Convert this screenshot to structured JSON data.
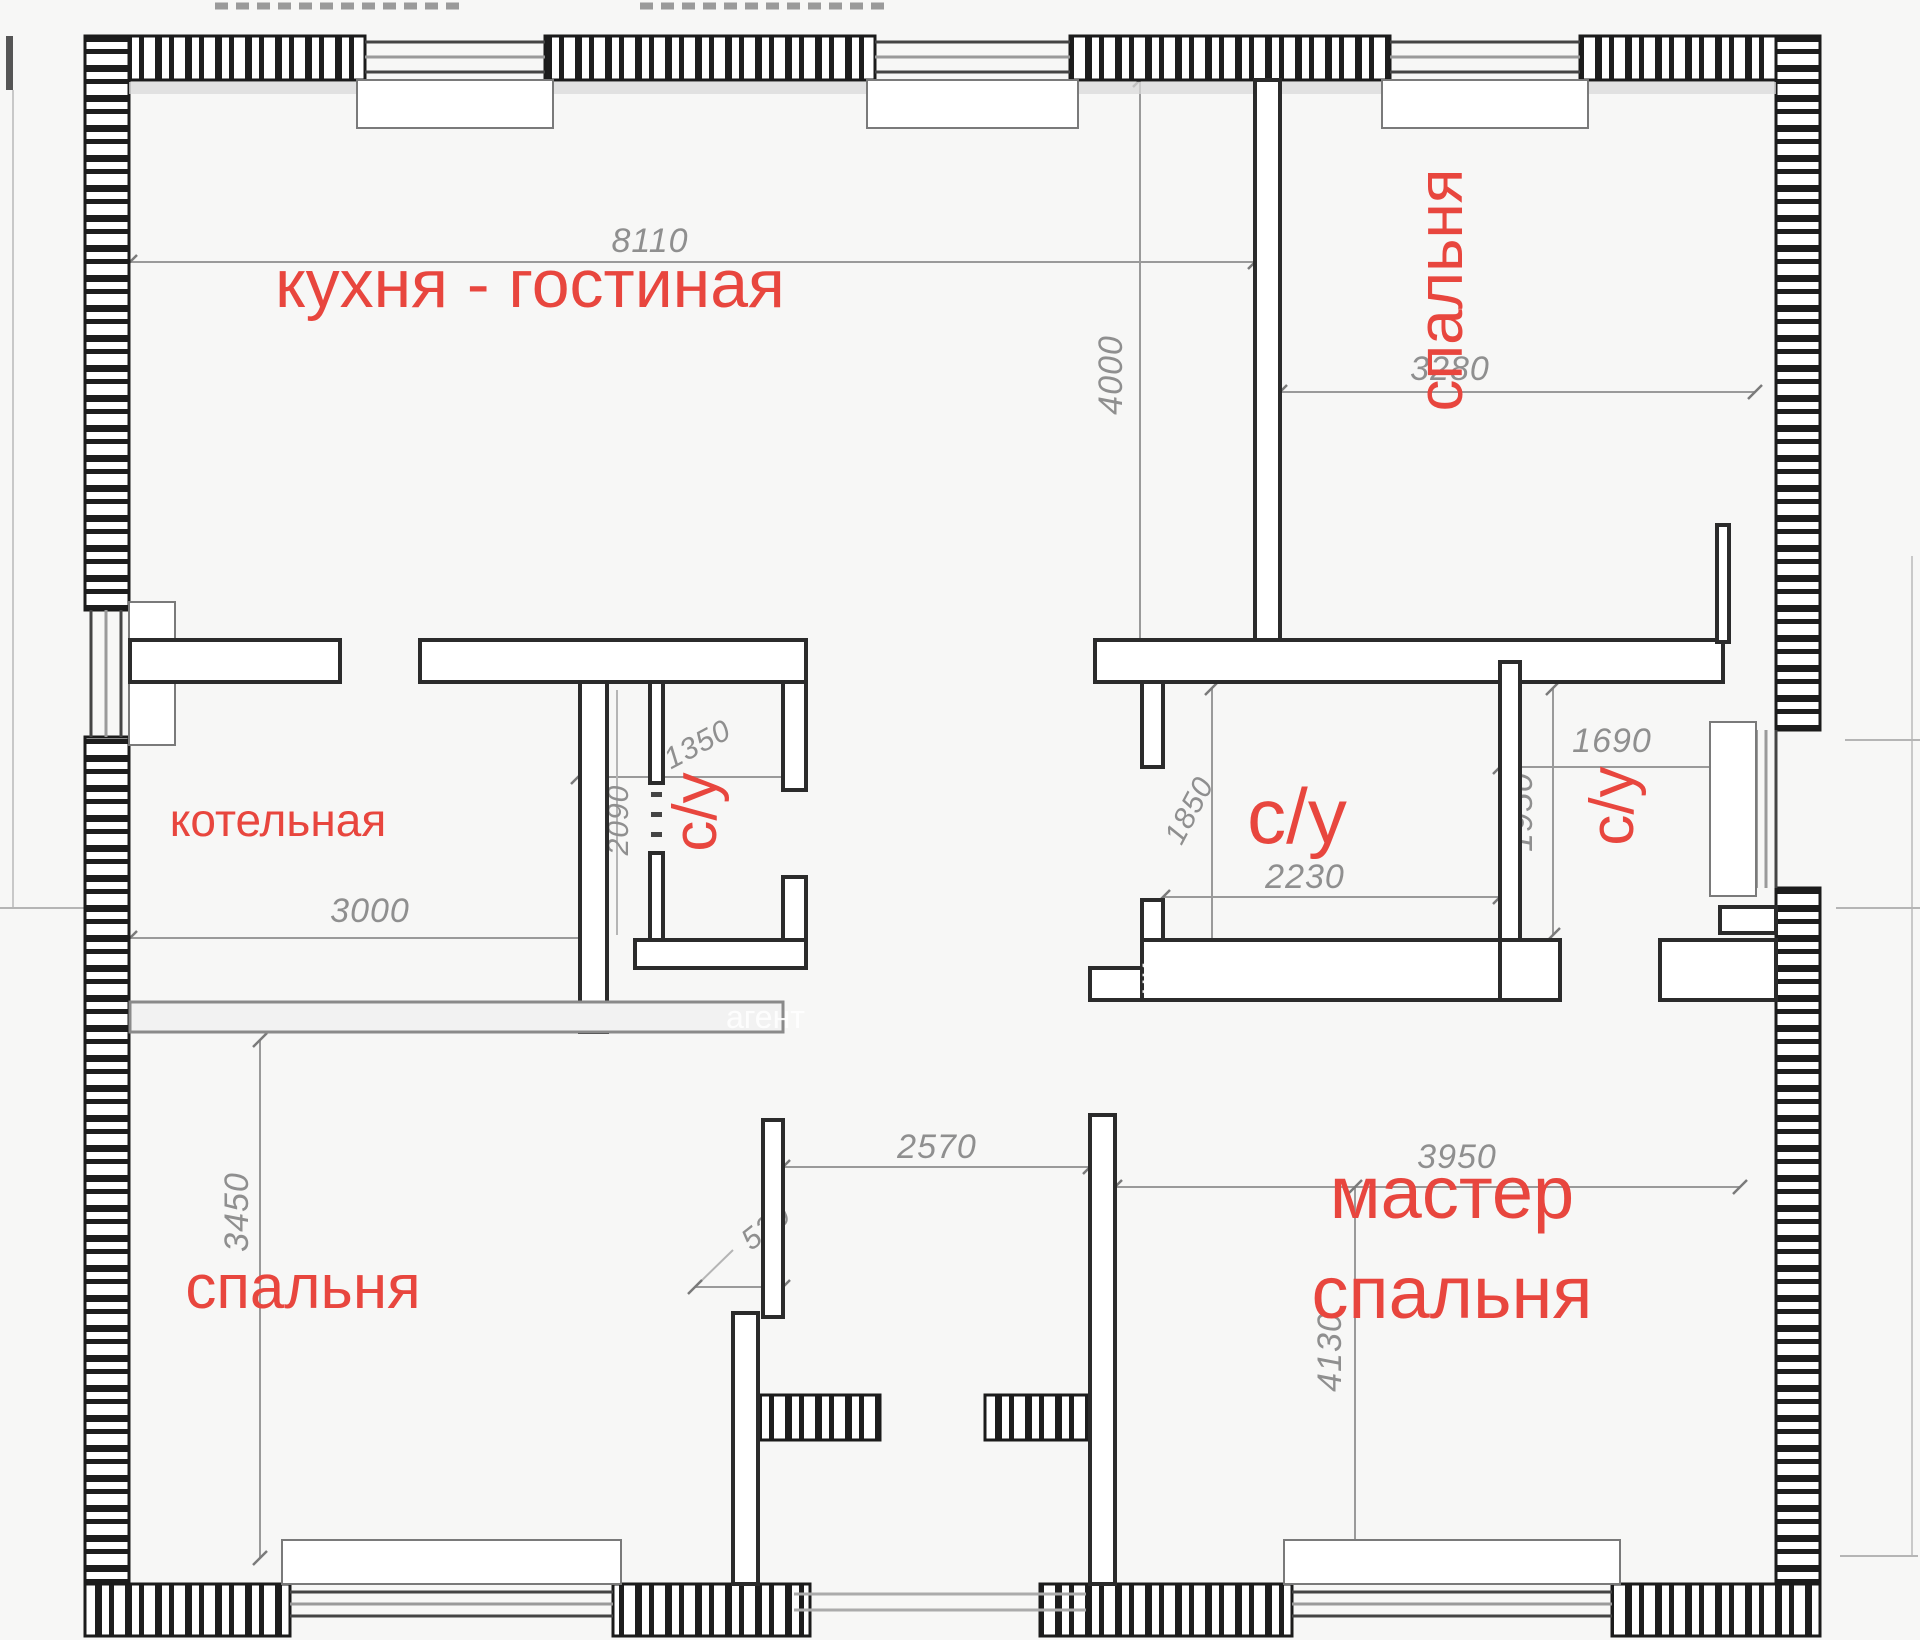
{
  "plan": {
    "rooms": [
      {
        "id": "kitchen-living",
        "label": "кухня - гостиная"
      },
      {
        "id": "bedroom-top-right",
        "label": "спальня"
      },
      {
        "id": "boiler-room",
        "label": "котельная"
      },
      {
        "id": "bathroom-center",
        "label": "с/у"
      },
      {
        "id": "bathroom-main",
        "label": "с/у"
      },
      {
        "id": "bathroom-ensuite",
        "label": "с/у"
      },
      {
        "id": "bedroom-bottom-left",
        "label": "спальня"
      },
      {
        "id": "master-bedroom",
        "label_line1": "мастер",
        "label_line2": "спальня"
      }
    ],
    "dimensions_mm": {
      "kitchen_width": "8110",
      "kitchen_depth": "4000",
      "bedroom_top_width": "3280",
      "boiler_width": "3000",
      "bath_center_width": "1350",
      "bath_center_depth": "2090",
      "bath_main_width": "2230",
      "bath_main_depth": "1850",
      "bath_ensuite_width": "1690",
      "bath_ensuite_depth": "1950",
      "bedroom_bottom_depth": "3450",
      "hall_width": "2570",
      "entry_offset": "520",
      "master_width": "3950",
      "master_depth": "4130"
    },
    "watermark": {
      "fragment1": "агент",
      "fragment2": "ни"
    },
    "colors": {
      "room_label": "#e8463e",
      "dimension_text": "#8f8f8f",
      "wall": "#1e1e1e",
      "window_glass": "#9a9a9a"
    }
  }
}
